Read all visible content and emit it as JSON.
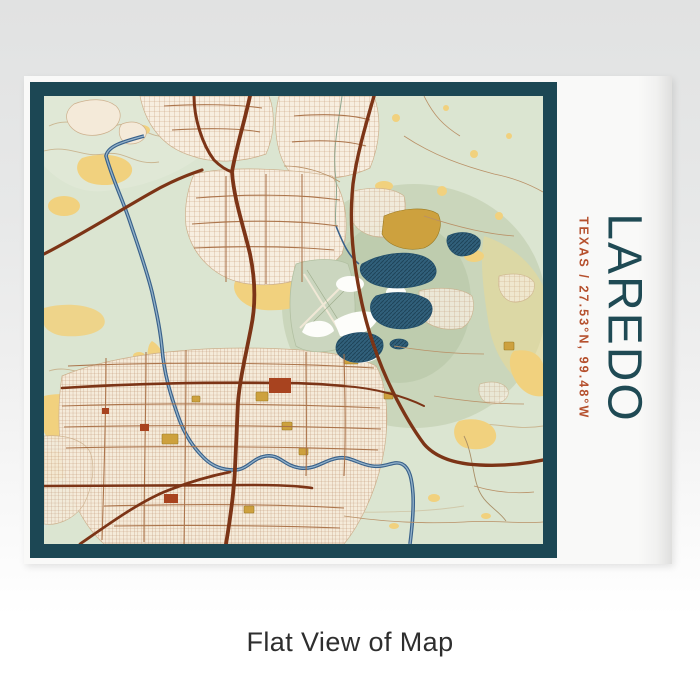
{
  "page": {
    "caption": "Flat View of Map"
  },
  "print": {
    "title": "LAREDO",
    "subtitle": "TEXAS / 27.53°N, 99.48°W",
    "colors": {
      "frame": "#1c4754",
      "title_text": "#1f4a54",
      "subtitle_text": "#b5502d",
      "map_base": "#dbe5d1",
      "map_urban_fill": "#f7eee0",
      "map_sand": "#f1d17e",
      "map_mustard": "#cda13e",
      "map_river": "#39618a",
      "map_lake": "#31607b",
      "map_road_major": "#7c3416",
      "map_road_medium": "#a97046",
      "map_road_minor": "#b99066",
      "map_accent_block": "#a8431f"
    }
  }
}
